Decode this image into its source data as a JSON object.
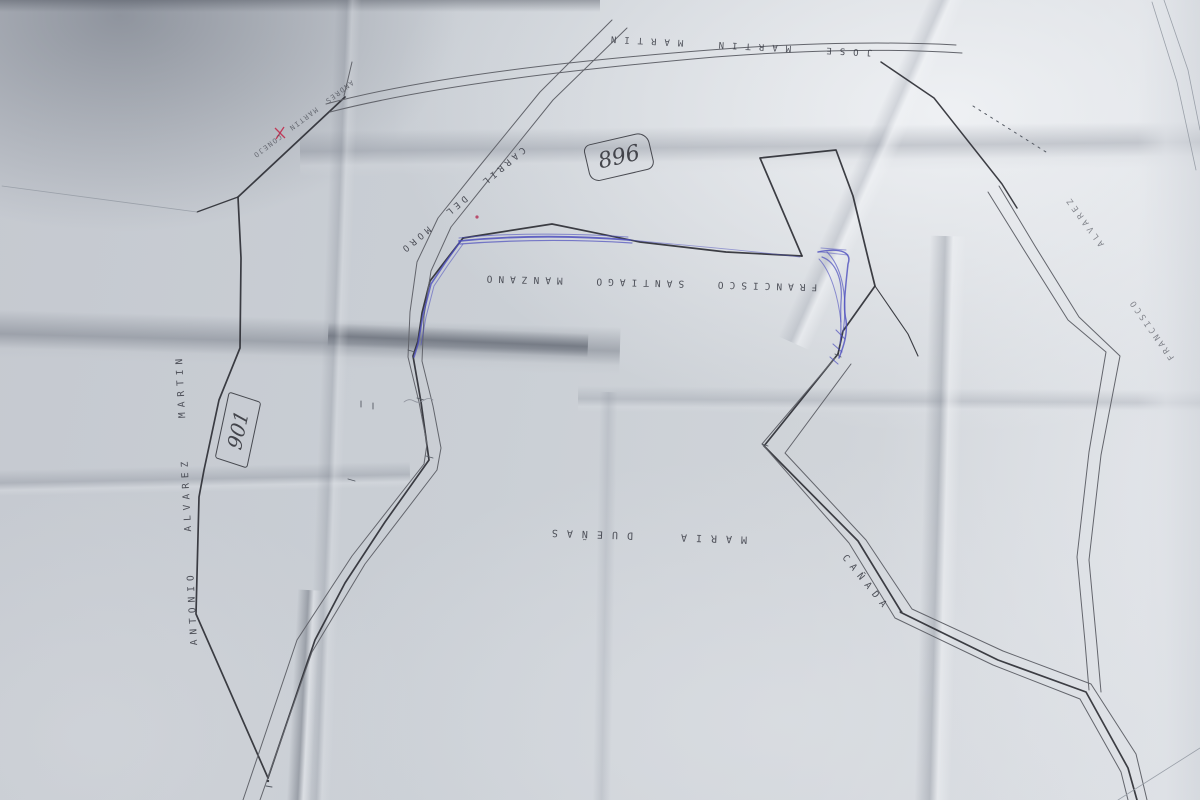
{
  "photo": {
    "description": "Photograph of a folded paper cadastral sketch map with typed owner names, hand-drawn parcel boundaries, blue ballpoint annotations and red marks",
    "paper_color": "#cdd1d7",
    "ink_colors": {
      "boundary": "#2e2f35",
      "road": "#63656c",
      "blue_pen": "#4d4fbe",
      "red_mark": "#c03a58",
      "typed_text": "#3f414a"
    }
  },
  "labels": {
    "top_owner": "JOSE MARTIN MARTIN",
    "northwest_owner": "ANDRES MARTIN CONEJO",
    "road": "CARRIL DEL MORO",
    "central_owner": "FRANCISCO SANTIAGO MANZANO",
    "west_owner": "ANTONIO ALVAREZ MARTIN",
    "south_owner": "MARIA DUEÑAS",
    "track": "CAÑADA",
    "east_owner_surname": "ALVAREZ",
    "east_owner_name": "FRANCISCO"
  },
  "parcel_numbers": {
    "north": "896",
    "west": "901"
  }
}
